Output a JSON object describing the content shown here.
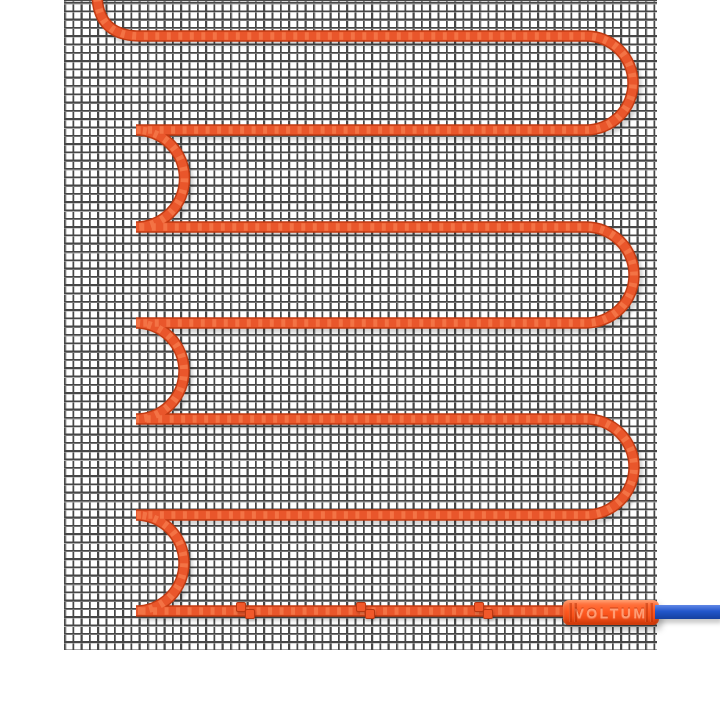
{
  "theme": {
    "bg": "#ffffff",
    "mesh-line": "#474747",
    "mesh-hi": "#a8a8a8",
    "cable-outline": "#bf3a12",
    "cable-main": "#e9562b",
    "cable-hi": "#ff9766",
    "clip": "#f1582a",
    "clip-border": "#b93711",
    "conn": "#ff5a22",
    "conn-light": "#ff804d",
    "conn-dark": "#e8430d",
    "conn-text": "#ff9d74",
    "lead-top": "#6188e6",
    "lead-mid": "#2256cb",
    "lead-dark": "#15409f"
  },
  "mat": {
    "mesh": {
      "left": 64,
      "top": 0,
      "width": 593,
      "height": 650
    },
    "cable": {
      "entry_x": 97,
      "entry_top_y": -14,
      "entry_corner": 43,
      "run_left_x": 136,
      "run_right_x": 586,
      "rows_y": [
        36,
        130,
        227,
        323,
        419,
        515,
        611
      ],
      "end_x": 566
    },
    "clips": {
      "x_positions": [
        245,
        365,
        483
      ],
      "y_center": 611
    },
    "connector": {
      "label": "VOLTUM",
      "x": 563,
      "y": 600,
      "width": 96,
      "height": 25
    },
    "cold_lead": {
      "x": 655,
      "y": 605,
      "width": 65,
      "height": 14
    }
  }
}
